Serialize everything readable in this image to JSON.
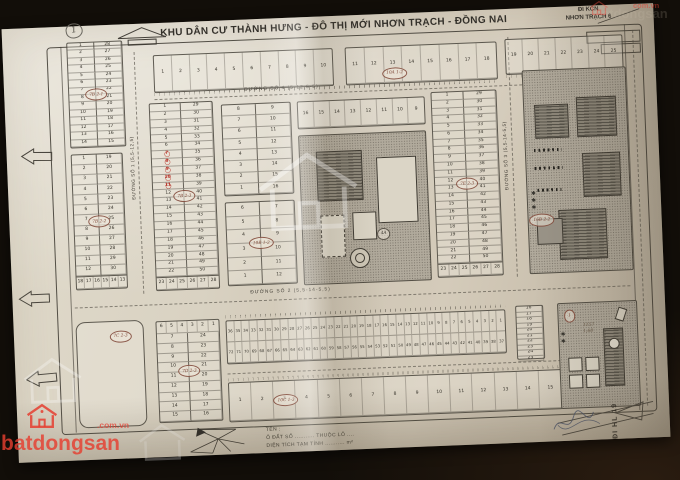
{
  "title": "KHU DÂN CƯ THÀNH HƯNG - ĐÔ THỊ MỚI NHƠN TRẠCH - ĐỒNG NAI",
  "page_mark": "1",
  "kcn": {
    "l1": "ĐI KCN",
    "l2": "NHƠN TRẠCH 6"
  },
  "hl19": "ĐI HL 19",
  "roads": {
    "r1": "ĐƯỜNG SỐ 1 (5,5-12,5)",
    "r2": "ĐƯỜNG SỐ 2 (5,5-14-5,5)",
    "r3": "ĐƯỜNG SỐ 3 (5,5-14-5,5)",
    "r4": "ĐƯỜNG SỐ 4 (5-12,5-5)"
  },
  "legend": {
    "l1": "TÊN :",
    "l2": "Ô ĐẤT SỐ ........... THUỘC LÔ ....",
    "l3": "DIỆN TÍCH TẠM TÍNH ........... m²"
  },
  "special": {
    "br_note1": "1157",
    "br_note2": "1,60"
  },
  "watermark": {
    "brand": "batdongsan",
    "domain": ".com.vn",
    "tr_domain": "com.vn",
    "tr_ghost": "batdongsan"
  },
  "blocks": {
    "t1": {
      "row": [
        "1",
        "2",
        "3",
        "4",
        "5",
        "6",
        "7",
        "8",
        "9",
        "10"
      ]
    },
    "t2": {
      "row": [
        "11",
        "12",
        "13",
        "14",
        "15",
        "16",
        "17",
        "18"
      ],
      "label": "10A 1-2"
    },
    "t3": {
      "row": [
        "19",
        "20",
        "21",
        "22",
        "23",
        "24",
        "25"
      ]
    },
    "ul": {
      "left": [
        "1",
        "2",
        "3",
        "4",
        "5",
        "6",
        "7",
        "8",
        "9",
        "10",
        "11",
        "12",
        "13",
        "14"
      ],
      "right": [
        "28",
        "27",
        "26",
        "25",
        "24",
        "23",
        "22",
        "21",
        "20",
        "19",
        "18",
        "17",
        "16",
        "15"
      ],
      "label": "7B 2-1"
    },
    "ml": {
      "left": [
        "1",
        "2",
        "3",
        "4",
        "5",
        "6",
        "7",
        "8",
        "9",
        "10",
        "11",
        "12"
      ],
      "right": [
        "19",
        "20",
        "21",
        "22",
        "23",
        "24",
        "25",
        "26",
        "27",
        "28",
        "29",
        "30"
      ],
      "bottom": [
        "18",
        "17",
        "16",
        "15",
        "14",
        "13"
      ],
      "label": "7B 2-2"
    },
    "l2": {
      "left": [
        "1",
        "2",
        "3",
        "4",
        "5",
        "6",
        "7",
        "8",
        "9",
        "10",
        "11",
        "12",
        "13",
        "14",
        "15",
        "16",
        "17",
        "18",
        "19",
        "20",
        "21",
        "22"
      ],
      "right": [
        "29",
        "30",
        "31",
        "32",
        "33",
        "34",
        "35",
        "36",
        "37",
        "38",
        "39",
        "40",
        "41",
        "42",
        "43",
        "44",
        "45",
        "46",
        "47",
        "48",
        "49",
        "50"
      ],
      "bottom": [
        "23",
        "24",
        "25",
        "26",
        "27",
        "28"
      ],
      "red": [
        "7",
        "8",
        "9",
        "10",
        "11"
      ],
      "label": "7B 2-3"
    },
    "c1": {
      "left": [
        "8",
        "7",
        "6",
        "5",
        "4",
        "3",
        "2",
        "1"
      ],
      "right": [
        "9",
        "10",
        "11",
        "12",
        "13",
        "14",
        "15",
        "16"
      ]
    },
    "c2": {
      "left": [
        "6",
        "5",
        "4",
        "3",
        "2",
        "1"
      ],
      "right": [
        "7",
        "8",
        "9",
        "10",
        "11",
        "12"
      ],
      "label": "10B 1-2"
    },
    "ct": {
      "row": [
        "16",
        "15",
        "14",
        "13",
        "12",
        "11",
        "10",
        "9"
      ]
    },
    "a4": {
      "label": "4A"
    },
    "r1b": {
      "left": [
        "1",
        "2",
        "3",
        "4",
        "5",
        "6",
        "7",
        "8",
        "9",
        "10",
        "11",
        "12",
        "13",
        "14",
        "15",
        "16",
        "17",
        "18",
        "19",
        "20",
        "21",
        "22"
      ],
      "right": [
        "29",
        "30",
        "31",
        "32",
        "33",
        "34",
        "35",
        "36",
        "37",
        "38",
        "39",
        "40",
        "41",
        "42",
        "43",
        "44",
        "45",
        "46",
        "47",
        "48",
        "49",
        "50"
      ],
      "bottom": [
        "23",
        "24",
        "25",
        "26",
        "27",
        "28"
      ],
      "label": "7E 2-3"
    },
    "r2x": {
      "label": "16B 2-2"
    },
    "c7": {
      "label": "7C 2-3"
    },
    "d7": {
      "rows": [
        [
          "6",
          "5",
          "4",
          "3",
          "2",
          "1"
        ]
      ],
      "left": [
        "7",
        "8",
        "9",
        "10",
        "11",
        "12",
        "13",
        "14",
        "15"
      ],
      "right": [
        "24",
        "23",
        "22",
        "21",
        "20",
        "19",
        "18",
        "17",
        "16"
      ],
      "label": "7D 2-3"
    },
    "bc1": {
      "rows": [
        [
          "36",
          "35",
          "34",
          "33",
          "32",
          "31",
          "30",
          "29",
          "28",
          "27",
          "26",
          "25",
          "24",
          "23",
          "22",
          "21",
          "20",
          "19",
          "18",
          "17",
          "16",
          "15",
          "14",
          "13",
          "12",
          "11",
          "10",
          "9",
          "8",
          "7",
          "6",
          "5",
          "4",
          "3",
          "2",
          "1"
        ],
        [
          "72",
          "71",
          "70",
          "69",
          "68",
          "67",
          "66",
          "65",
          "64",
          "63",
          "62",
          "61",
          "60",
          "59",
          "58",
          "57",
          "56",
          "55",
          "54",
          "53",
          "52",
          "51",
          "50",
          "49",
          "48",
          "47",
          "46",
          "45",
          "44",
          "43",
          "42",
          "41",
          "40",
          "39",
          "38",
          "37"
        ]
      ]
    },
    "bc2": {
      "row": [
        "1",
        "2",
        "3",
        "4",
        "5",
        "6",
        "7",
        "8",
        "9",
        "10",
        "11",
        "12",
        "13",
        "14",
        "15"
      ],
      "label": "10C 1-3"
    },
    "rc": {
      "col": [
        "16",
        "17",
        "18",
        "19",
        "20",
        "21",
        "22",
        "23",
        "24",
        "25"
      ]
    },
    "br": {
      "label": "1"
    }
  }
}
